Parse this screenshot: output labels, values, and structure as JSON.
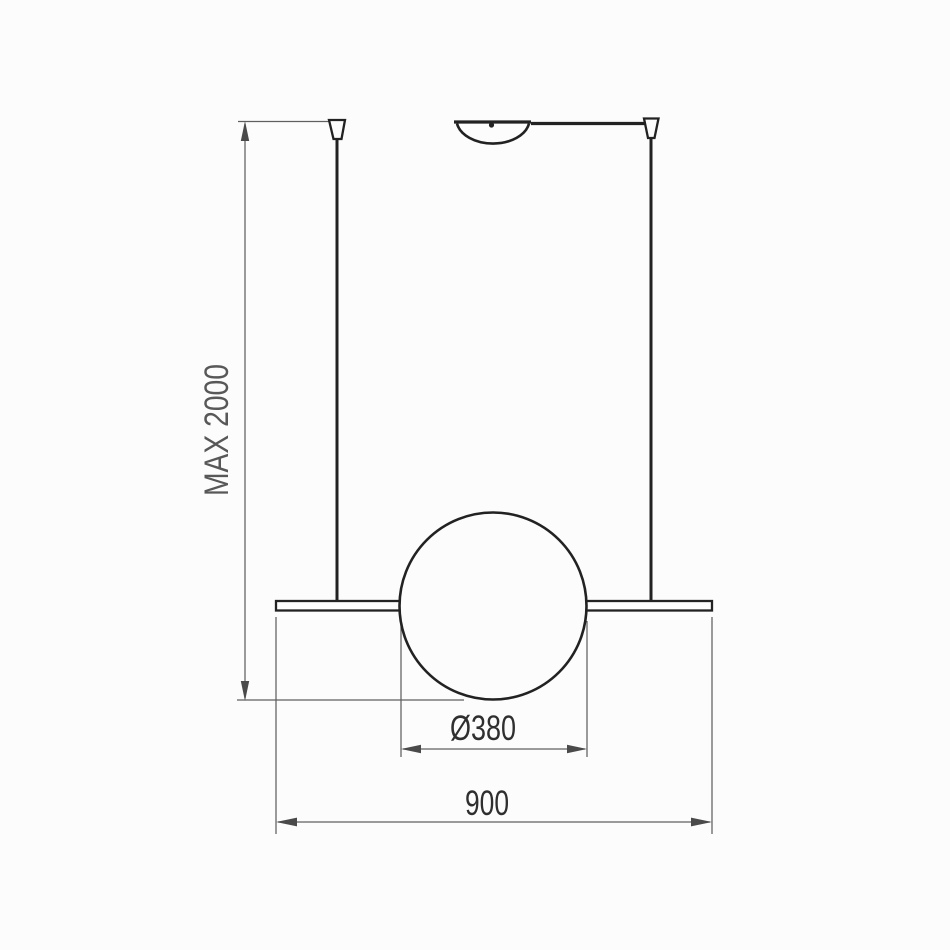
{
  "page": {
    "background": "#fcfcfc",
    "description": "Technical dimension drawing of a linear pendant lamp with sphere diffuser"
  },
  "drawing": {
    "colors": {
      "object_line": "#222222",
      "dimension_line": "#5f5f5f",
      "dimension_text": "#2f2f2f",
      "height_text": "#585858"
    },
    "labels": {
      "max_height": "MAX 2000",
      "sphere_diameter": "Ø380",
      "bar_width": "900"
    }
  }
}
